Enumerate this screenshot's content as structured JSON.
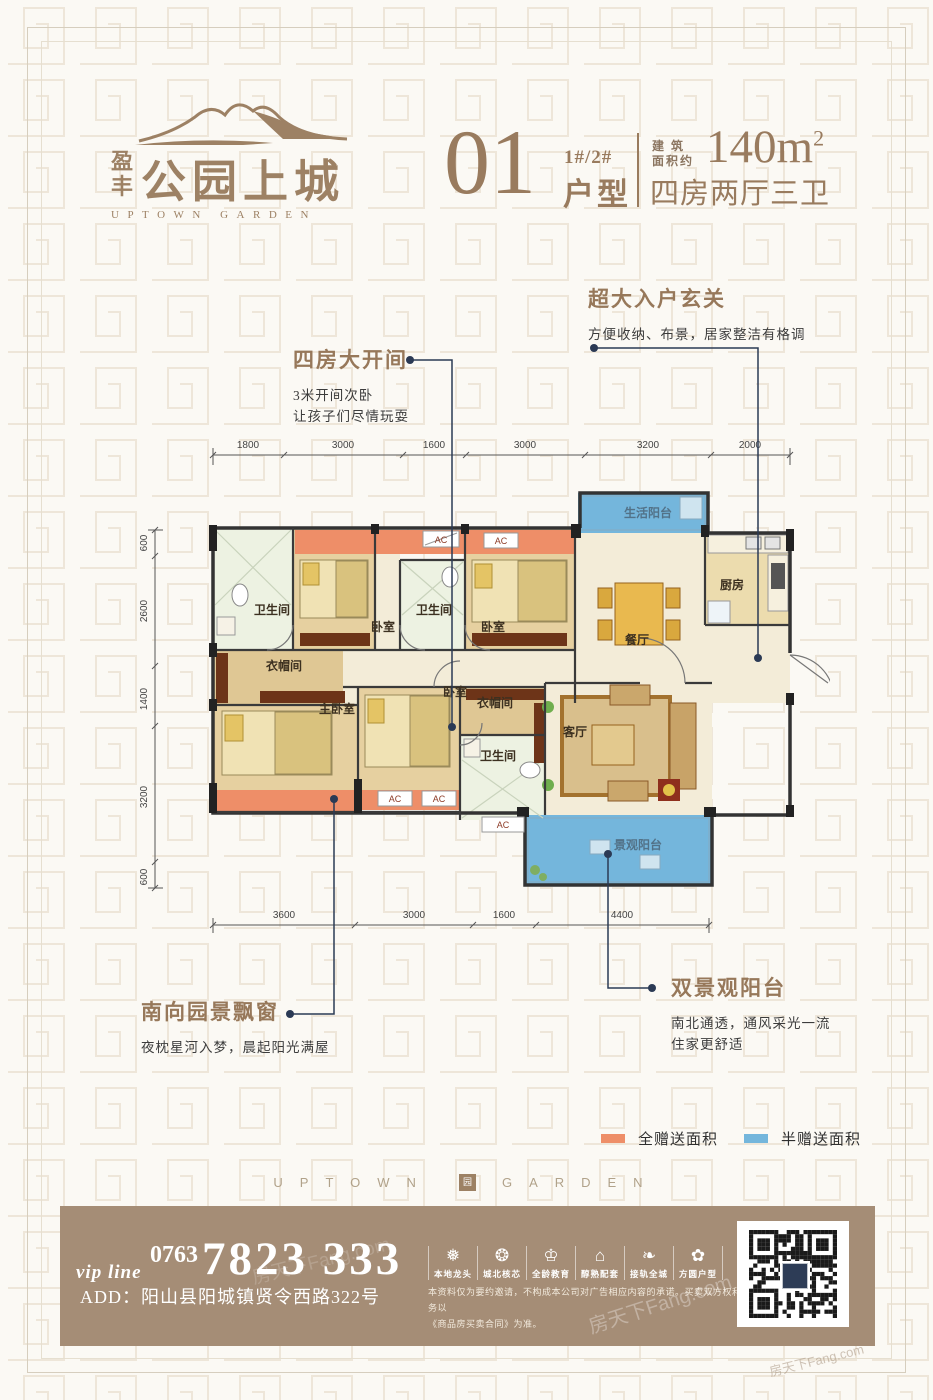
{
  "brand": {
    "logo_cn_1": "盈",
    "logo_cn_2": "丰",
    "name": "公园上城",
    "name_en": "UPTOWN GARDEN"
  },
  "unit": {
    "number": "01",
    "buildings": "1#/2#",
    "type_label": "户型",
    "area_label_1": "建 筑",
    "area_label_2": "面积约",
    "area_value": "140m",
    "area_sup": "2",
    "rooms": "四房两厅三卫"
  },
  "annotations": [
    {
      "title": "超大入户玄关",
      "line1": "方便收纳、布景，居家整洁有格调"
    },
    {
      "title": "四房大开间",
      "line1": "3米开间次卧",
      "line2": "让孩子们尽情玩耍"
    },
    {
      "title": "南向园景飘窗",
      "line1": "夜枕星河入梦，晨起阳光满屋"
    },
    {
      "title": "双景观阳台",
      "line1": "南北通透，通风采光一流",
      "line2": "住家更舒适"
    }
  ],
  "plan": {
    "labels": {
      "bath": "卫生间",
      "bedroom": "卧室",
      "master": "主卧室",
      "closet": "衣帽间",
      "life_balcony": "生活阳台",
      "kitchen": "厨房",
      "dining": "餐厅",
      "living": "客厅",
      "view_balcony": "景观阳台",
      "ac": "AC"
    },
    "dims_top": [
      "1800",
      "3000",
      "1600",
      "3000",
      "3200",
      "2000"
    ],
    "dims_left": [
      "600",
      "2600",
      "1400",
      "3200",
      "600"
    ],
    "dims_bottom": [
      "3600",
      "3000",
      "1600",
      "4400"
    ]
  },
  "legend": {
    "full": {
      "label": "全赠送面积",
      "color": "#ee8e68"
    },
    "half": {
      "label": "半赠送面积",
      "color": "#74b6dc"
    }
  },
  "band": {
    "left": "UPTOWN",
    "right": "GARDEN",
    "seal": "园"
  },
  "footer": {
    "vip": "vip line",
    "area_code": "0763",
    "phone": "7823 333",
    "address": "ADD：阳山县阳城镇贤令西路322号",
    "features": [
      {
        "icon": "❅",
        "label": "本地龙头"
      },
      {
        "icon": "❂",
        "label": "城北核芯"
      },
      {
        "icon": "♔",
        "label": "全龄教育"
      },
      {
        "icon": "⌂",
        "label": "醇熟配套"
      },
      {
        "icon": "❧",
        "label": "接轨全城"
      },
      {
        "icon": "✿",
        "label": "方圆户型"
      }
    ],
    "disclaimer1": "本资料仅为要约邀请，不构成本公司对广告相应内容的承诺。买卖双方权利义务以",
    "disclaimer2": "《商品房买卖合同》为准。",
    "watermark": "房天下Fang.com"
  }
}
